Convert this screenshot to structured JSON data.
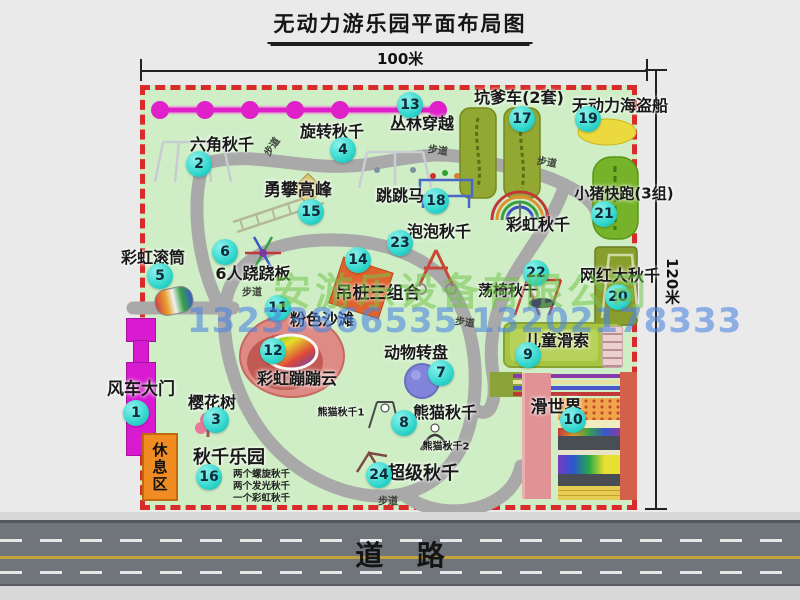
{
  "title": "无动力游乐园平面布局图",
  "dimensions": {
    "width_label": "100米",
    "height_label": "120米"
  },
  "road": {
    "label": "道路"
  },
  "watermark": {
    "company": "安游乐设备有限公司",
    "phone": "13233866535 13202178333"
  },
  "path_label": "步道",
  "rest_area_label": "休息区",
  "extra_labels": {
    "rainbow_swing": "彩虹秋千",
    "panda_swing_1": "熊猫秋千1",
    "panda_swing_2": "熊猫秋千2"
  },
  "swing_park_notes": [
    "两个螺旋秋千",
    "两个发光秋千",
    "一个彩虹秋千"
  ],
  "colors": {
    "map_green": "#cfeec5",
    "border_red": "#d92b2b",
    "badge_cyan": "#2fd6cc",
    "zipline_magenta": "#e020c8",
    "gate_magenta": "#d81ad0",
    "road_gray": "#70747b",
    "rest_area_orange": "#f08c22"
  },
  "attractions": [
    {
      "num": "1",
      "label": "风车大门"
    },
    {
      "num": "2",
      "label": "六角秋千"
    },
    {
      "num": "3",
      "label": "樱花树"
    },
    {
      "num": "4",
      "label": "旋转秋千"
    },
    {
      "num": "5",
      "label": "彩虹滚筒"
    },
    {
      "num": "6",
      "label": "6人跷跷板"
    },
    {
      "num": "7",
      "label": "动物转盘"
    },
    {
      "num": "8",
      "label": "熊猫秋千"
    },
    {
      "num": "9",
      "label": "儿童滑索"
    },
    {
      "num": "10",
      "label": "滑世界"
    },
    {
      "num": "11",
      "label": "粉色沙滩"
    },
    {
      "num": "12",
      "label": "彩虹蹦蹦云"
    },
    {
      "num": "13",
      "label": "丛林穿越"
    },
    {
      "num": "14",
      "label": "吊桩三组合"
    },
    {
      "num": "15",
      "label": "勇攀高峰"
    },
    {
      "num": "16",
      "label": "秋千乐园"
    },
    {
      "num": "17",
      "label": "坑爹车(2套)"
    },
    {
      "num": "18",
      "label": "跳跳马"
    },
    {
      "num": "19",
      "label": "无动力海盗船"
    },
    {
      "num": "20",
      "label": "网红大秋千"
    },
    {
      "num": "21",
      "label": "小猪快跑(3组)"
    },
    {
      "num": "22",
      "label": "荡椅秋千"
    },
    {
      "num": "23",
      "label": "泡泡秋千"
    },
    {
      "num": "24",
      "label": "超级秋千"
    }
  ]
}
